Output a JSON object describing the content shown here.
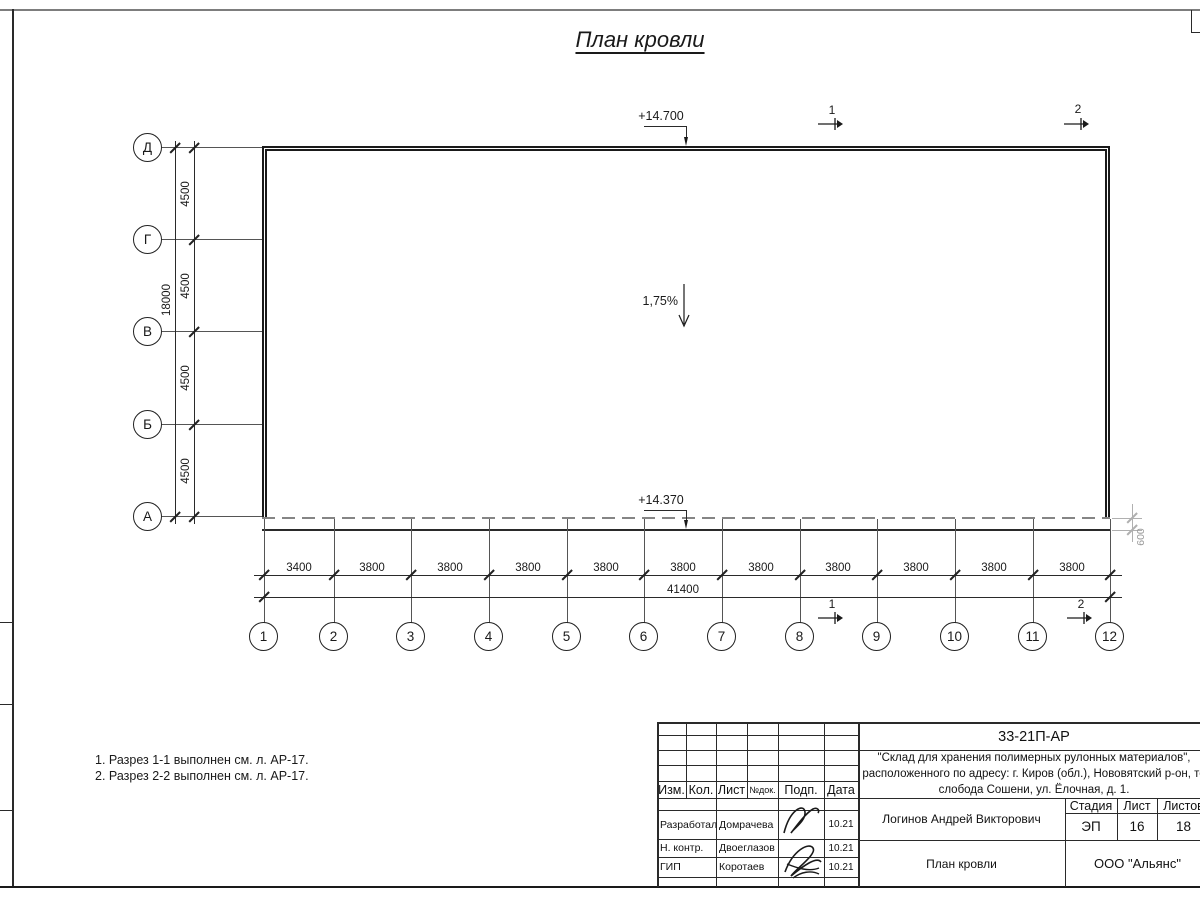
{
  "sheet": {
    "title": "План кровли",
    "notes": [
      "1. Разрез 1-1 выполнен см. л. АР-17.",
      "2. Разрез 2-2 выполнен см. л. АР-17."
    ]
  },
  "plan": {
    "elevation_top": "+14.700",
    "elevation_bottom": "+14.370",
    "slope": "1,75%",
    "overhang": "600",
    "row_axes": [
      "Д",
      "Г",
      "В",
      "Б",
      "А"
    ],
    "row_spacings": [
      "4500",
      "4500",
      "4500",
      "4500"
    ],
    "row_total": "18000",
    "col_axes": [
      "1",
      "2",
      "3",
      "4",
      "5",
      "6",
      "7",
      "8",
      "9",
      "10",
      "11",
      "12"
    ],
    "col_spacings": [
      "3400",
      "3800",
      "3800",
      "3800",
      "3800",
      "3800",
      "3800",
      "3800",
      "3800",
      "3800",
      "3800"
    ],
    "col_total": "41400",
    "section_1": "1",
    "section_2": "2"
  },
  "titleblock": {
    "doc_code": "33-21П-АР",
    "project": [
      "\"Склад для хранения полимерных рулонных материалов\",",
      "расположенного по адресу: г. Киров (обл.), Нововятский р-он, те",
      "слобода Сошени, ул. Ёлочная, д. 1."
    ],
    "header_cols": [
      "Изм.",
      "Кол.",
      "Лист",
      "№док.",
      "Подп.",
      "Дата"
    ],
    "rows": [
      {
        "role": "Разработал",
        "name": "Домрачева",
        "date": "10.21"
      },
      {
        "role": "Н. контр.",
        "name": "Двоеглазов",
        "date": "10.21"
      },
      {
        "role": "ГИП",
        "name": "Коротаев",
        "date": "10.21"
      }
    ],
    "approver": "Логинов Андрей Викторович",
    "drawing_title": "План кровли",
    "stage_label": "Стадия",
    "sheet_label": "Лист",
    "sheets_label": "Листов",
    "stage": "ЭП",
    "sheet_no": "16",
    "sheets_total": "18",
    "company": "ООО \"Альянс\""
  },
  "colors": {
    "line": "#1a1a1a",
    "hidden_line": "#858585",
    "light_dim": "#b0b0b0"
  }
}
